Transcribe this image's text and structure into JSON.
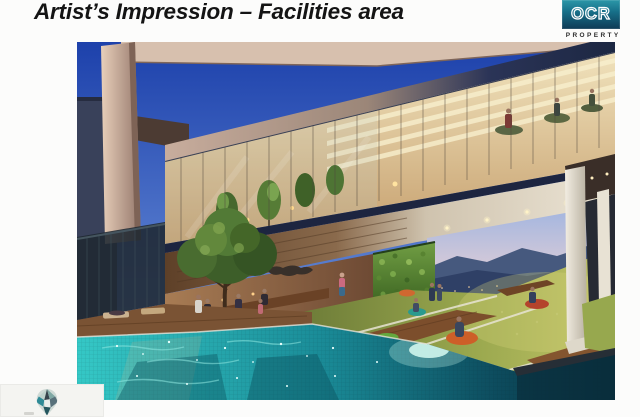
{
  "slide": {
    "title": "Artist’s Impression – Facilities area"
  },
  "logo": {
    "brand": "OCR",
    "tagline": "PROPERTY",
    "box_gradient_top": "#2b97a8",
    "box_gradient_bottom": "#0e3a55"
  },
  "artwork": {
    "alt": "Dusk artist impression of facilities deck: infinity pool with teal mosaic tiles, lawn lounge with bean bags, vertical green wall, city and mountain view, glass-walled gym with treadmills above"
  },
  "palette": {
    "sky_blue": "#1f44ae",
    "pool_teal": "#35c8c6",
    "lawn_green": "#9aa84e",
    "green_wall": "#5d8a34",
    "navy_fascia": "#1d2540",
    "wood_deck": "#7a5334"
  }
}
